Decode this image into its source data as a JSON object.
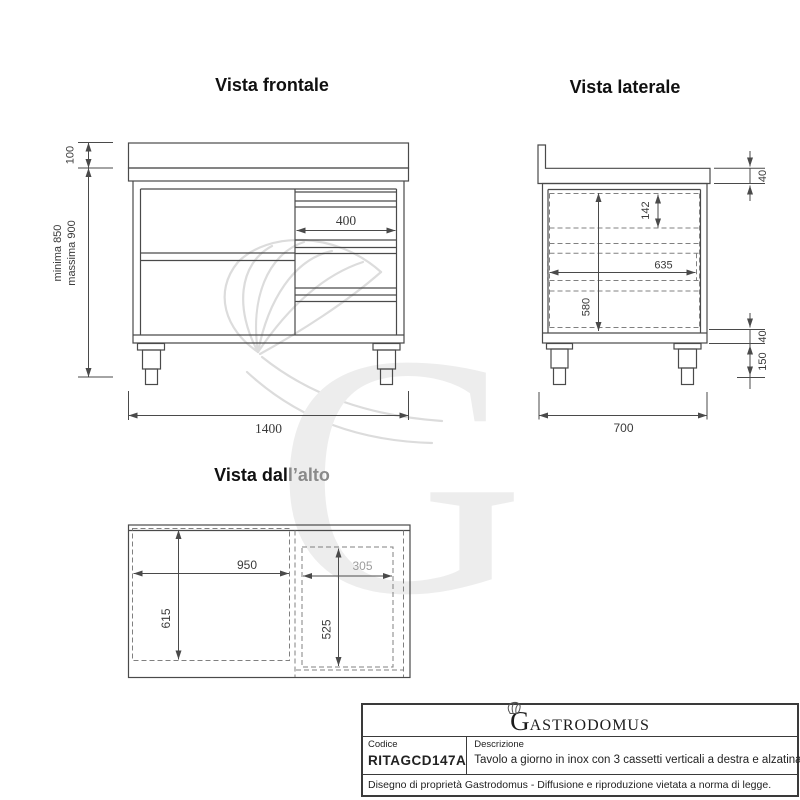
{
  "views": {
    "front": {
      "title": "Vista frontale",
      "dims": {
        "backsplash_height": "100",
        "height_min": "minima 850",
        "height_max": "massima 900",
        "drawer_width": "400",
        "total_width": "1400"
      }
    },
    "side": {
      "title": "Vista laterale",
      "dims": {
        "top_thickness": "40",
        "drawer_height": "142",
        "inner_depth": "635",
        "body_height": "580",
        "base_thickness": "40",
        "leg_height": "150",
        "total_depth": "700"
      }
    },
    "top": {
      "title_black": "Vista dal",
      "title_gray": "l’alto",
      "dims": {
        "open_width": "950",
        "open_depth": "615",
        "drawer_width": "305",
        "drawer_depth": "525"
      }
    }
  },
  "watermark": {
    "letter": "G"
  },
  "title_block": {
    "logo_initial": "G",
    "logo_rest": "ASTRODOMUS",
    "codice_label": "Codice",
    "codice_value": "RITAGCD147A",
    "descrizione_label": "Descrizione",
    "descrizione_value": "Tavolo a giorno in inox con 3 cassetti verticali a destra e alzatina",
    "footer": "Disegno di proprietà Gastrodomus -  Diffusione e riproduzione vietata a norma di legge."
  }
}
